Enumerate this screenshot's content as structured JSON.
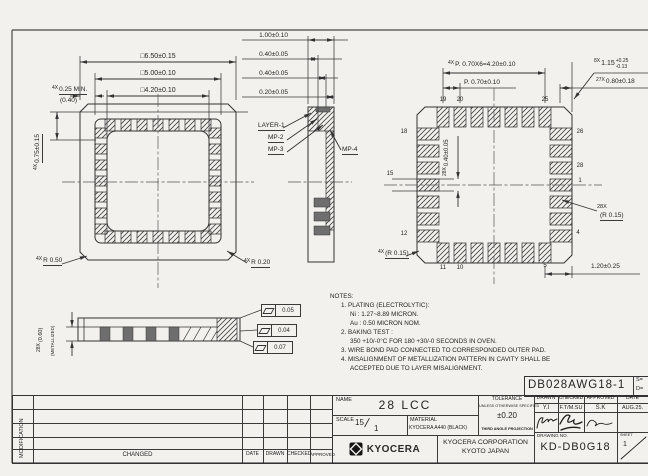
{
  "plan": {
    "dim_outer": "□6.50±0.15",
    "dim_mid": "□5.00±0.10",
    "dim_inner": "□4.20±0.10",
    "x4": "4X",
    "corner_min": "0.25 MIN.",
    "corner_ref": "(0.40)",
    "ledge": "0.75±0.15",
    "r_out": "R 0.50",
    "r_in": "R 0.20"
  },
  "section": {
    "dims": [
      "1.00±0.10",
      "0.40±0.05",
      "0.40±0.05",
      "0.20±0.05"
    ],
    "layer1": "LAYER-1",
    "mp2": "MP-2",
    "mp3": "MP-3",
    "mp4": "MP-4"
  },
  "bottom": {
    "x4": "4X",
    "pitch_total": "P. 0.70X6=4.20±0.10",
    "pitch": "P. 0.70±0.10",
    "x8": "8X",
    "pad_len": "1.15",
    "pad_len_p": "+0.25",
    "pad_len_m": "-0.13",
    "x27": "27X",
    "pad27": "0.80±0.18",
    "x28": "28X",
    "pad_w": "0.40±0.05",
    "r15": "(R 0.15)",
    "corner_dim": "1.20±0.25",
    "pins_top": [
      "19",
      "20",
      "25"
    ],
    "pins_left": [
      "18",
      "15",
      "12"
    ],
    "pins_right": [
      "26",
      "28",
      "1",
      "4"
    ],
    "pins_bottom": [
      "11",
      "10",
      "5"
    ]
  },
  "side": {
    "x28": "28X",
    "met_h": "(0.60)",
    "met": "(METALLIZED)",
    "flatness": [
      "0.05",
      "0.04",
      "0.07"
    ]
  },
  "notes": {
    "lines": [
      "NOTES:",
      "1. PLATING (ELECTROLYTIC):",
      "Ni : 1.27~8.89 MICRON.",
      "Au : 0.50 MICRON NOM.",
      "2. BAKING TEST :",
      "350 +10/-0°C FOR 180 +30/-0 SECONDS IN OVEN.",
      "3. WIRE BOND PAD CONNECTED TO CORRESPONDED OUTER PAD.",
      "4. MISALIGNMENT OF METALLIZATION PATTERN IN CAVITY SHALL BE",
      "ACCEPTED DUE TO LAYER MISALIGNMENT."
    ]
  },
  "rev": {
    "modification": "MODIFICATION",
    "changed": "CHANGED",
    "date": "DATE",
    "drawn": "DRAWN",
    "checked": "CHECKED",
    "approved": "APPROVED"
  },
  "tb": {
    "part_no": "DB028AWG18-1",
    "s": "S=",
    "d": "D=",
    "name_label": "NAME",
    "name": "28 LCC",
    "scale_label": "SCALE",
    "scale_num": "15",
    "scale_den": "1",
    "material_label": "MATERIAL",
    "material": "KYOCERA A440 (BLACK)",
    "tol_label": "TOLERANCE",
    "tol_sub": "UNLESS OTHERWISE SPECIFIED",
    "tol": "±0.20",
    "projection": "THIRD ANGLE PROJECTION",
    "drawn_label": "DRAWN",
    "checked_label": "CHECKED",
    "approved_label": "APPROVED",
    "date_label": "DATE",
    "drawn": "Y.I",
    "checked": "F.T/M.SU",
    "approved": "S.K",
    "date": "AUG.25.",
    "company": "KYOCERA CORPORATION",
    "city": "KYOTO JAPAN",
    "logo": "KYOCERA",
    "dno_label": "DRAWING NO.",
    "dno": "KD-DB0G18",
    "sheet_label": "SHEET",
    "sheet": "1"
  }
}
